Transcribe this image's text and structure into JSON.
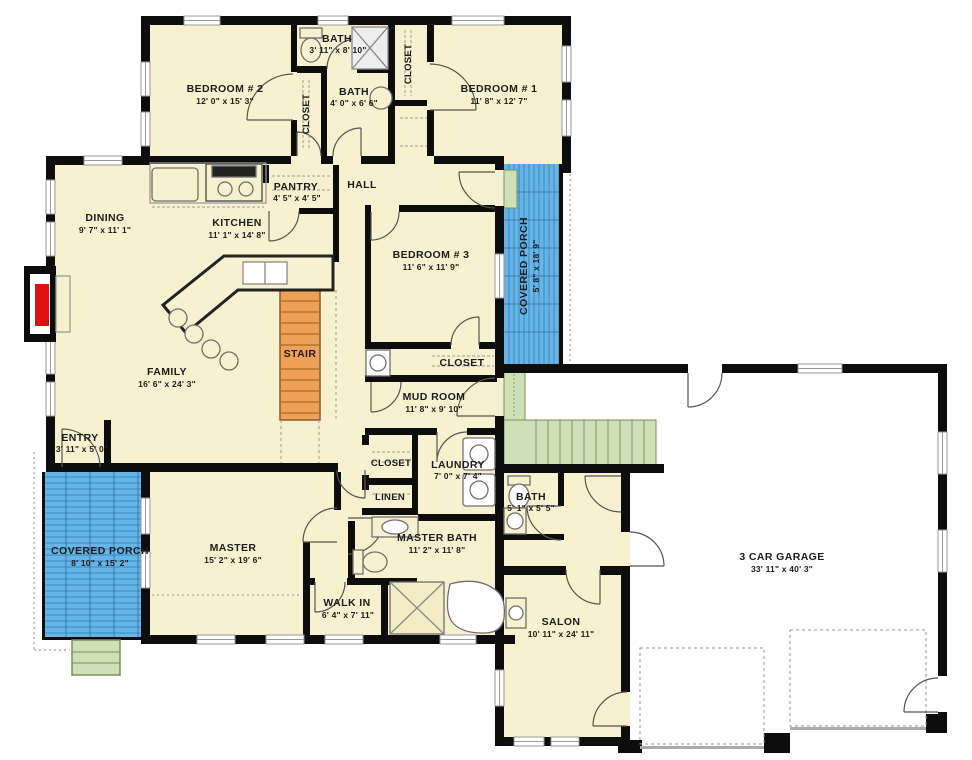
{
  "palette": {
    "floor": "#F8F1CF",
    "wall": "#0d0d0d",
    "porch_blue": "#66B5E7",
    "porch_hatch": "#3F86BA",
    "stair_orange": "#EFA057",
    "stair_tread": "#A96A24",
    "steps_green": "#CDE0B6",
    "steps_border": "#76925C",
    "fireplace_red": "#E01010",
    "window_gray": "#999999",
    "fixture_gray": "#8a8a8a"
  },
  "rooms": [
    {
      "name": "BEDROOM # 2",
      "dims": "12' 0\" x 15' 3\""
    },
    {
      "name": "BATH",
      "dims": "3' 11\" x 8' 10\""
    },
    {
      "name": "CLOSET",
      "dims": ""
    },
    {
      "name": "BATH",
      "dims": "4' 0\" x 6' 6\""
    },
    {
      "name": "CLOSET",
      "dims": ""
    },
    {
      "name": "BEDROOM # 1",
      "dims": "11' 8\" x 12' 7\""
    },
    {
      "name": "DINING",
      "dims": "9' 7\" x 11' 1\""
    },
    {
      "name": "KITCHEN",
      "dims": "11' 1\" x 14' 8\""
    },
    {
      "name": "PANTRY",
      "dims": "4' 5\" x 4' 5\""
    },
    {
      "name": "HALL",
      "dims": ""
    },
    {
      "name": "BEDROOM # 3",
      "dims": "11' 6\" x 11' 9\""
    },
    {
      "name": "COVERED PORCH",
      "dims": "5' 8\" x 18' 9\""
    },
    {
      "name": "FAMILY",
      "dims": "16' 6\" x 24' 3\""
    },
    {
      "name": "STAIR",
      "dims": ""
    },
    {
      "name": "CLOSET",
      "dims": ""
    },
    {
      "name": "ENTRY",
      "dims": "3' 11\" x 5' 0\""
    },
    {
      "name": "MUD ROOM",
      "dims": "11' 8\" x 9' 10\""
    },
    {
      "name": "CLOSET",
      "dims": ""
    },
    {
      "name": "LINEN",
      "dims": ""
    },
    {
      "name": "LAUNDRY",
      "dims": "7' 0\" x 7' 4\""
    },
    {
      "name": "BATH",
      "dims": "5' 1\" x 5' 5\""
    },
    {
      "name": "COVERED PORCH",
      "dims": "8' 10\" x 15' 2\""
    },
    {
      "name": "MASTER",
      "dims": "15' 2\" x 19' 6\""
    },
    {
      "name": "WALK IN",
      "dims": "6' 4\" x 7' 11\""
    },
    {
      "name": "MASTER BATH",
      "dims": "11' 2\" x 11' 8\""
    },
    {
      "name": "SALON",
      "dims": "10' 11\" x 24' 11\""
    },
    {
      "name": "3 CAR GARAGE",
      "dims": "33' 11\" x 40' 3\""
    }
  ]
}
